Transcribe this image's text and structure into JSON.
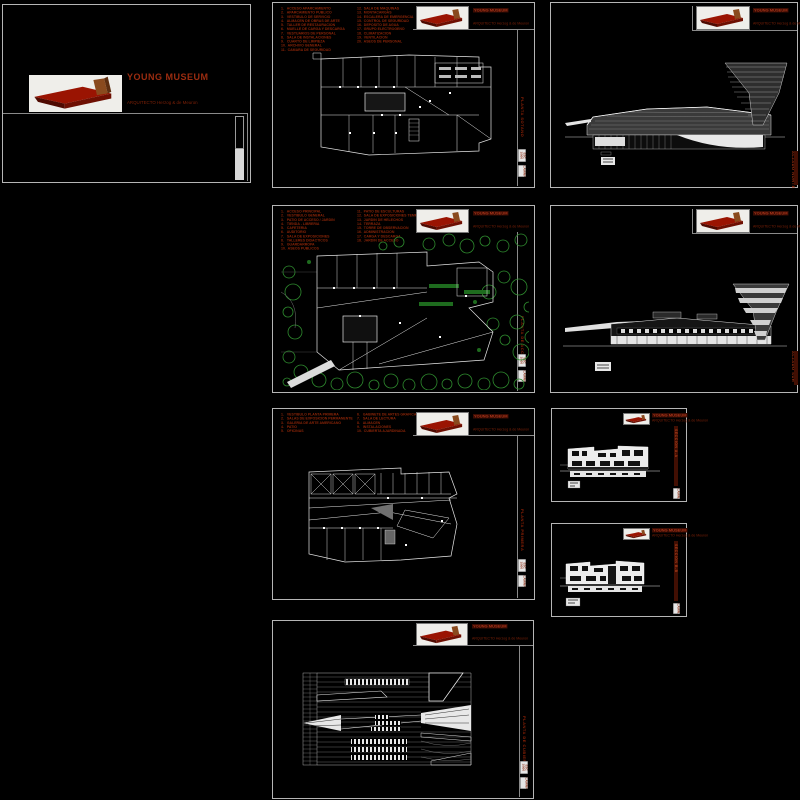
{
  "app": {
    "background": "#000000"
  },
  "colors": {
    "accent_red": "#9c2c10",
    "dim_red": "#7c2007",
    "strip_red": "#420f03",
    "sheet_border": "#b5b5b5",
    "drawing_white": "#e6e6e6",
    "tree_green": "#2e8b2e"
  },
  "cover": {
    "title": "YOUNG MUSEUM",
    "architect": "ARQUITECTO Herzog & de Meuron"
  },
  "titleblock": {
    "project": "YOUNG MUSEUM",
    "architect": "ARQUITECTO Herzog & de Meuron"
  },
  "stamps": {
    "scale": "ESC 1/500",
    "lamina": "LAMINA"
  },
  "sheets": {
    "basement": {
      "side_label": "PLANTA SOTANO",
      "legend_left": [
        "1.   ACCESO APARCAMIENTO",
        "2.   APARCAMIENTO PUBLICO",
        "3.   VESTIBULO DE SERVICIO",
        "4.   ALMACEN DE OBRAS DE ARTE",
        "5.   TALLER DE RESTAURACION",
        "6.   MUELLE DE CARGA Y DESCARGA",
        "7.   VESTUARIOS DE PERSONAL",
        "8.   SALA DE INSTALACIONES",
        "9.   CUARTO DE LIMPIEZA",
        "10.  ARCHIVO GENERAL",
        "11.  CAMARA DE SEGURIDAD"
      ],
      "legend_right": [
        "12.  SALA DE MAQUINAS",
        "13.  MONTACARGAS",
        "14.  ESCALERA DE EMERGENCIA",
        "15.  CONTROL DE SEGURIDAD",
        "16.  DEPOSITO DE AGUA",
        "17.  GRUPO ELECTROGENO",
        "18.  CLIMATIZACION",
        "19.  VENTILACION",
        "20.  ASEOS DE PERSONAL"
      ]
    },
    "elevation_north": {
      "side_label": "ALZADO NORTE"
    },
    "site": {
      "side_label": "PLANTA DE ACCESO",
      "legend_left": [
        "1.   ACCESO PRINCIPAL",
        "2.   VESTIBULO GENERAL",
        "3.   PATIO DE ACCESO / JARDIN",
        "4.   TIENDA - LIBRERIA",
        "5.   CAFETERIA",
        "6.   AUDITORIO",
        "7.   SALA DE EXPOSICIONES",
        "8.   TALLERES DIDACTICOS",
        "9.   GUARDARROPA",
        "10.  ASEOS PUBLICOS"
      ],
      "legend_right": [
        "11.  PATIO DE ESCULTURAS",
        "12.  SALA DE EXPOSICIONES TEMPORALES",
        "13.  JARDIN DE HELECHOS",
        "14.  TERRAZA",
        "15.  TORRE DE OBSERVACION",
        "16.  ADMINISTRACION",
        "17.  CARGA Y DESCARGA",
        "18.  JARDIN DE ACCESO"
      ]
    },
    "elevation_south": {
      "side_label": "ALZADO SUR"
    },
    "upper": {
      "side_label": "PLANTA PRIMERA",
      "legend_left": [
        "1.   VESTIBULO PLANTA PRIMERA",
        "2.   SALAS DE EXPOSICION PERMANENTE",
        "3.   GALERIA DE ARTE AMERICANO",
        "4.   PATIO",
        "5.   OFICINAS"
      ],
      "legend_right": [
        "6.   GABINETE DE ARTES GRAFICAS",
        "7.   SALA DE LECTURA",
        "8.   ALMACEN",
        "9.   INSTALACIONES",
        "10.  CUBIERTA AJARDINADA"
      ]
    },
    "section_a": {
      "side_label": "SECCION A-A"
    },
    "section_b": {
      "side_label": "SECCION B-B"
    },
    "roof": {
      "side_label": "PLANTA DE CUBIERTAS"
    }
  }
}
